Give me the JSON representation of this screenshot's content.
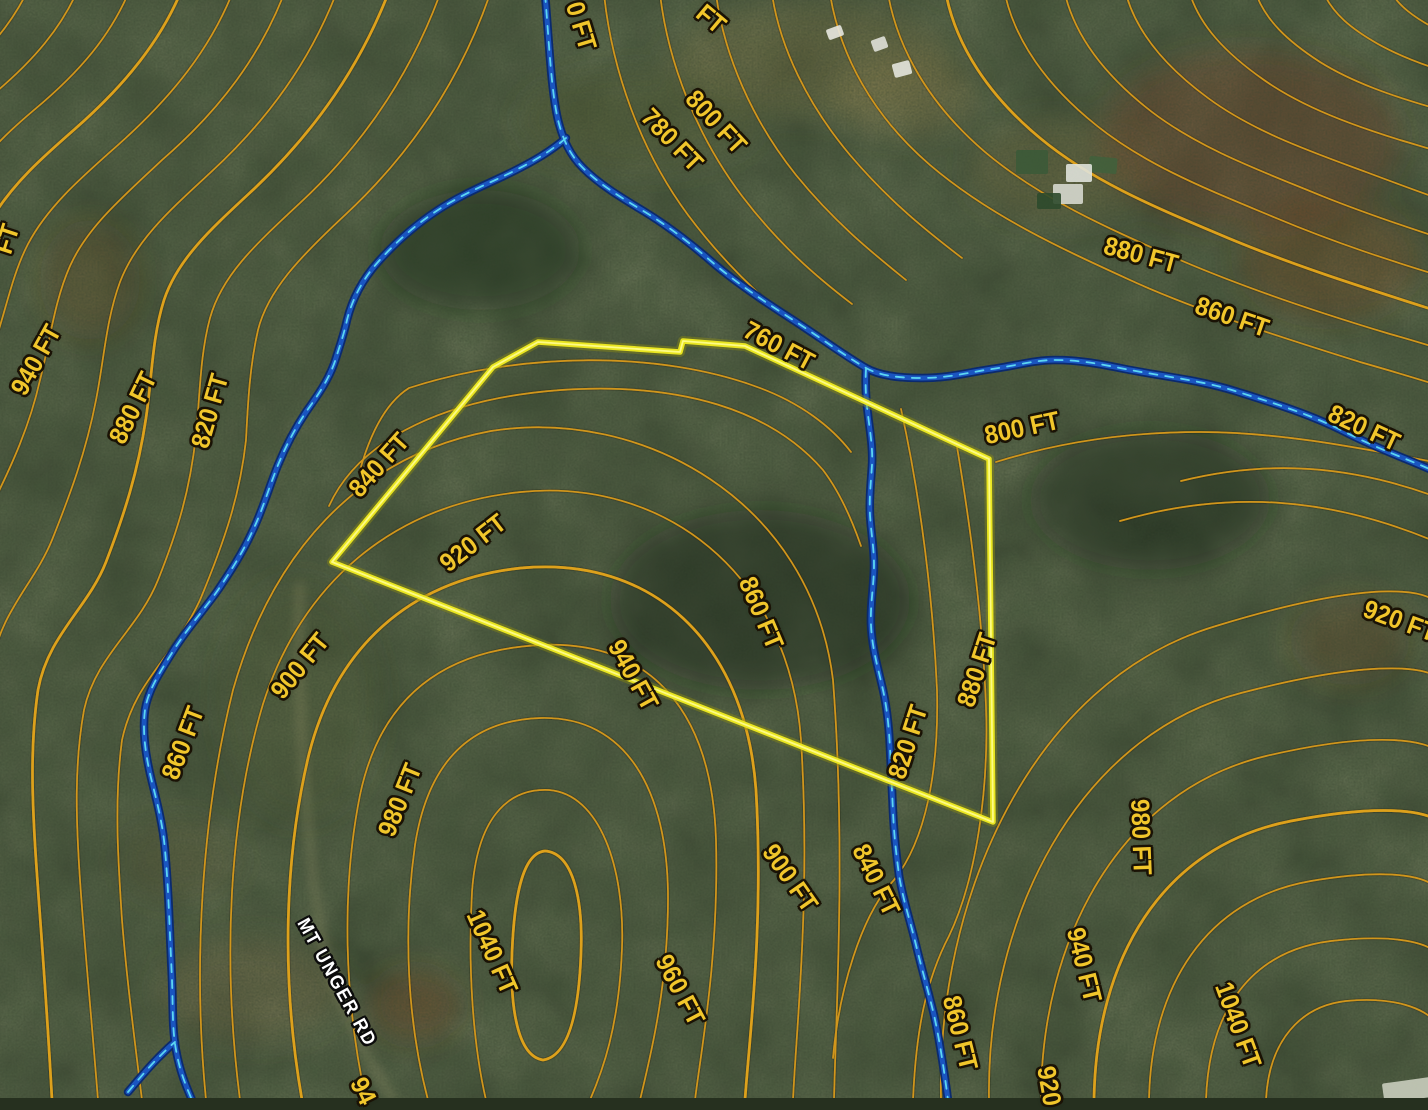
{
  "map": {
    "title": "topographic-contour-parcel-map",
    "units": "FT",
    "colors": {
      "contour": "#d1961d",
      "contour-major": "#dda11b",
      "label": "#f1c62b",
      "label-outline": "#1a1205",
      "boundary": "#e9e520",
      "boundary-core": "#fdfb86",
      "boundary-halo": "#8a8a14",
      "stream": "#1a55c0",
      "stream-case": "#0b2a6e",
      "stream-dash": "#5cd6f2",
      "road-label": "#ffffff"
    },
    "boundary": {
      "name": "parcel-boundary",
      "vertices": [
        [
          332,
          562
        ],
        [
          493,
          367
        ],
        [
          538,
          342
        ],
        [
          680,
          352
        ],
        [
          683,
          341
        ],
        [
          745,
          346
        ],
        [
          989,
          459
        ],
        [
          993,
          822
        ]
      ]
    },
    "labels": [
      {
        "text": "0 FT",
        "x": 581,
        "y": 26,
        "rot": 73,
        "kind": "elevation",
        "partial": true
      },
      {
        "text": "FT",
        "x": 711,
        "y": 19,
        "rot": 40,
        "kind": "elevation",
        "partial": true
      },
      {
        "text": "800 FT",
        "x": 716,
        "y": 122,
        "rot": 47,
        "kind": "elevation"
      },
      {
        "text": "780 FT",
        "x": 672,
        "y": 140,
        "rot": 46,
        "kind": "elevation"
      },
      {
        "text": "880 FT",
        "x": 1141,
        "y": 255,
        "rot": 15,
        "kind": "elevation"
      },
      {
        "text": "860 FT",
        "x": 1232,
        "y": 317,
        "rot": 19,
        "kind": "elevation"
      },
      {
        "text": "940 FT",
        "x": 36,
        "y": 360,
        "rot": -61,
        "kind": "elevation"
      },
      {
        "text": "FT",
        "x": 7,
        "y": 239,
        "rot": -72,
        "kind": "elevation",
        "partial": true
      },
      {
        "text": "880 FT",
        "x": 133,
        "y": 408,
        "rot": -64,
        "kind": "elevation"
      },
      {
        "text": "820 FT",
        "x": 210,
        "y": 411,
        "rot": -74,
        "kind": "elevation"
      },
      {
        "text": "840 FT",
        "x": 379,
        "y": 465,
        "rot": -48,
        "kind": "elevation"
      },
      {
        "text": "760 FT",
        "x": 779,
        "y": 346,
        "rot": 28,
        "kind": "elevation"
      },
      {
        "text": "800 FT",
        "x": 1022,
        "y": 428,
        "rot": -12,
        "kind": "elevation"
      },
      {
        "text": "820 FT",
        "x": 1364,
        "y": 428,
        "rot": 25,
        "kind": "elevation"
      },
      {
        "text": "920 FT",
        "x": 473,
        "y": 543,
        "rot": -38,
        "kind": "elevation"
      },
      {
        "text": "860 FT",
        "x": 761,
        "y": 613,
        "rot": 67,
        "kind": "elevation"
      },
      {
        "text": "920 FT",
        "x": 1400,
        "y": 621,
        "rot": 20,
        "kind": "elevation",
        "partial": true
      },
      {
        "text": "900 FT",
        "x": 300,
        "y": 666,
        "rot": -51,
        "kind": "elevation"
      },
      {
        "text": "940 FT",
        "x": 633,
        "y": 675,
        "rot": 61,
        "kind": "elevation"
      },
      {
        "text": "880 FT",
        "x": 977,
        "y": 670,
        "rot": -72,
        "kind": "elevation"
      },
      {
        "text": "820 FT",
        "x": 908,
        "y": 742,
        "rot": -72,
        "kind": "elevation"
      },
      {
        "text": "860 FT",
        "x": 183,
        "y": 743,
        "rot": -69,
        "kind": "elevation"
      },
      {
        "text": "980 FT",
        "x": 400,
        "y": 800,
        "rot": -68,
        "kind": "elevation"
      },
      {
        "text": "980 FT",
        "x": 1141,
        "y": 837,
        "rot": 88,
        "kind": "elevation"
      },
      {
        "text": "900 FT",
        "x": 790,
        "y": 878,
        "rot": 55,
        "kind": "elevation"
      },
      {
        "text": "840 FT",
        "x": 876,
        "y": 880,
        "rot": 64,
        "kind": "elevation"
      },
      {
        "text": "960 FT",
        "x": 680,
        "y": 990,
        "rot": 62,
        "kind": "elevation"
      },
      {
        "text": "860 FT",
        "x": 960,
        "y": 1033,
        "rot": 76,
        "kind": "elevation"
      },
      {
        "text": "1040 FT",
        "x": 492,
        "y": 952,
        "rot": 66,
        "kind": "elevation"
      },
      {
        "text": "940 FT",
        "x": 1084,
        "y": 965,
        "rot": 76,
        "kind": "elevation"
      },
      {
        "text": "1040 FT",
        "x": 1238,
        "y": 1025,
        "rot": 70,
        "kind": "elevation"
      },
      {
        "text": "920",
        "x": 1049,
        "y": 1086,
        "rot": 80,
        "kind": "elevation",
        "partial": true
      },
      {
        "text": "94",
        "x": 363,
        "y": 1091,
        "rot": 64,
        "kind": "elevation",
        "partial": true
      },
      {
        "text": "MT UNGER RD",
        "x": 336,
        "y": 983,
        "rot": 61,
        "kind": "road"
      }
    ],
    "structures": [
      {
        "x": 827,
        "y": 27,
        "w": 16,
        "h": 11,
        "color": "#e8e8e0",
        "rot": -20
      },
      {
        "x": 872,
        "y": 38,
        "w": 15,
        "h": 12,
        "color": "#dfe0d8",
        "rot": -20
      },
      {
        "x": 893,
        "y": 62,
        "w": 18,
        "h": 14,
        "color": "#e4e6de",
        "rot": -15
      },
      {
        "x": 1016,
        "y": 150,
        "w": 32,
        "h": 24,
        "color": "#3c5a38",
        "rot": 0
      },
      {
        "x": 1089,
        "y": 157,
        "w": 28,
        "h": 16,
        "color": "#41603c",
        "rot": 5
      },
      {
        "x": 1066,
        "y": 164,
        "w": 26,
        "h": 18,
        "color": "#dfe2da",
        "rot": 0
      },
      {
        "x": 1053,
        "y": 184,
        "w": 30,
        "h": 20,
        "color": "#d6d8ce",
        "rot": 0
      },
      {
        "x": 1037,
        "y": 193,
        "w": 24,
        "h": 16,
        "color": "#2e4a2c",
        "rot": 0
      },
      {
        "x": 1383,
        "y": 1080,
        "w": 52,
        "h": 20,
        "color": "#c9cdbd",
        "rot": -8
      }
    ]
  }
}
